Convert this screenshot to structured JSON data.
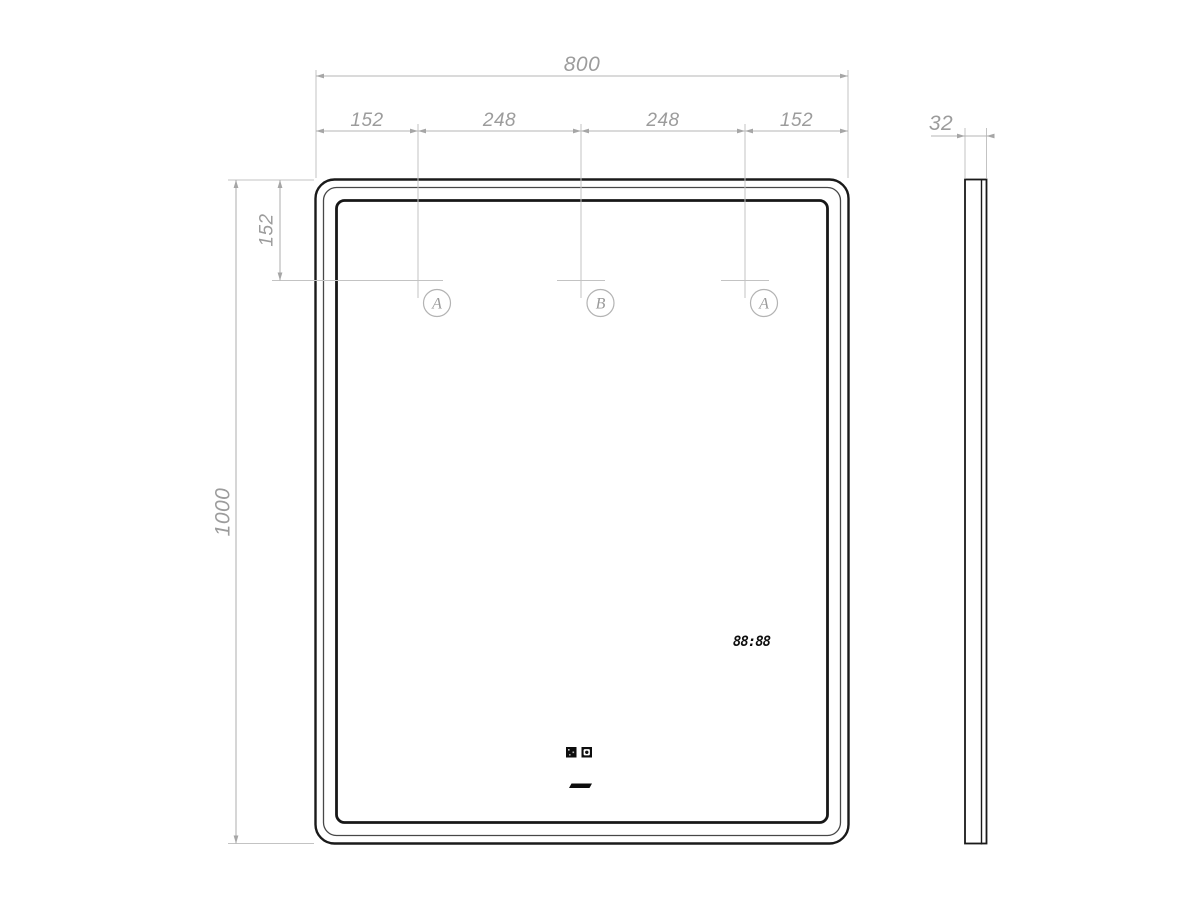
{
  "front_view": {
    "overall_width": "800",
    "segments": [
      "152",
      "248",
      "248",
      "152"
    ],
    "top_offset": "152",
    "overall_height": "1000",
    "mount_points": [
      "A",
      "B",
      "A"
    ],
    "clock": "88:88"
  },
  "side_view": {
    "thickness": "32"
  },
  "colors": {
    "outline": "#1a1a1a",
    "dimension_line": "#b5b5b5",
    "dimension_text": "#9c9c9c",
    "display_ink": "#0d0d0d"
  }
}
